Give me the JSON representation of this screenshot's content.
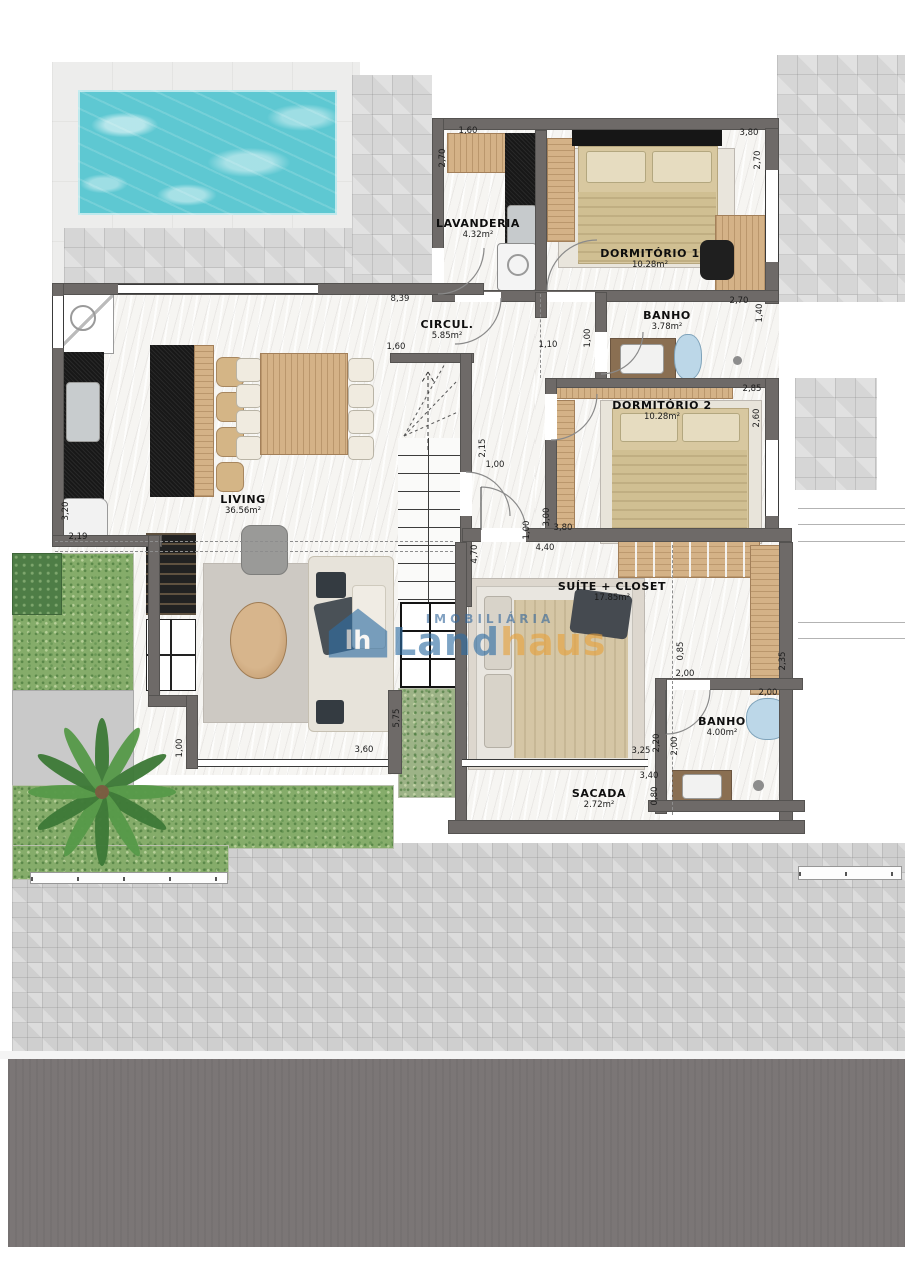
{
  "plan": {
    "rooms": [
      {
        "name": "LAVANDERIA",
        "area": "4.32m²"
      },
      {
        "name": "DORMITÓRIO 1",
        "area": "10.28m²"
      },
      {
        "name": "BANHO",
        "area": "3.78m²"
      },
      {
        "name": "CIRCUL.",
        "area": "5.85m²"
      },
      {
        "name": "DORMITÓRIO 2",
        "area": "10.28m²"
      },
      {
        "name": "LIVING",
        "area": "36.56m²"
      },
      {
        "name": "SUÍTE + CLOSET",
        "area": "17.85m²"
      },
      {
        "name": "BANHO",
        "area": "4.00m²"
      },
      {
        "name": "SACADA",
        "area": "2.72m²"
      }
    ],
    "dimensions": [
      {
        "t": "1,60",
        "x": 468,
        "y": 131
      },
      {
        "t": "2,70",
        "x": 443,
        "y": 158,
        "v": 1
      },
      {
        "t": "3,80",
        "x": 749,
        "y": 133
      },
      {
        "t": "2,70",
        "x": 758,
        "y": 160,
        "v": 1
      },
      {
        "t": "2,70",
        "x": 739,
        "y": 301
      },
      {
        "t": "1,40",
        "x": 760,
        "y": 313,
        "v": 1
      },
      {
        "t": "8,39",
        "x": 400,
        "y": 299
      },
      {
        "t": "1,60",
        "x": 396,
        "y": 347
      },
      {
        "t": "1,10",
        "x": 548,
        "y": 345
      },
      {
        "t": "1,00",
        "x": 588,
        "y": 338,
        "v": 1
      },
      {
        "t": "2,85",
        "x": 752,
        "y": 389
      },
      {
        "t": "2,60",
        "x": 757,
        "y": 418,
        "v": 1
      },
      {
        "t": "2,15",
        "x": 483,
        "y": 448,
        "v": 1
      },
      {
        "t": "1,00",
        "x": 495,
        "y": 465
      },
      {
        "t": "4,70",
        "x": 475,
        "y": 554,
        "v": 1
      },
      {
        "t": "1,00",
        "x": 527,
        "y": 530,
        "v": 1
      },
      {
        "t": "3,00",
        "x": 547,
        "y": 517,
        "v": 1
      },
      {
        "t": "3,80",
        "x": 563,
        "y": 528
      },
      {
        "t": "4,40",
        "x": 545,
        "y": 548
      },
      {
        "t": "3,20",
        "x": 66,
        "y": 511,
        "v": 1
      },
      {
        "t": "2,19",
        "x": 78,
        "y": 537
      },
      {
        "t": "0,85",
        "x": 681,
        "y": 651,
        "v": 1
      },
      {
        "t": "2,00",
        "x": 685,
        "y": 674
      },
      {
        "t": "2,35",
        "x": 783,
        "y": 661,
        "v": 1
      },
      {
        "t": "2,00",
        "x": 768,
        "y": 693
      },
      {
        "t": "2,20",
        "x": 657,
        "y": 743,
        "v": 1
      },
      {
        "t": "2,00",
        "x": 675,
        "y": 746,
        "v": 1
      },
      {
        "t": "3,25",
        "x": 641,
        "y": 751
      },
      {
        "t": "3,40",
        "x": 649,
        "y": 776
      },
      {
        "t": "0,80",
        "x": 655,
        "y": 796,
        "v": 1
      },
      {
        "t": "1,00",
        "x": 180,
        "y": 748,
        "v": 1
      },
      {
        "t": "3,60",
        "x": 364,
        "y": 750
      },
      {
        "t": "5,75",
        "x": 397,
        "y": 718,
        "v": 1
      }
    ]
  },
  "logo": {
    "tagline": "IMOBILIÁRIA",
    "brand_blue": "Land",
    "brand_orange": "haus"
  },
  "colors": {
    "water": "#5ec8d2",
    "grass": "#85ac6a",
    "wall": "#6e6a68",
    "wood": "#d4b287",
    "logo_blue": "#2e6da3",
    "logo_orange": "#e8a23c",
    "paving": "#d6d6d6",
    "dark_band": "#7b7676"
  }
}
